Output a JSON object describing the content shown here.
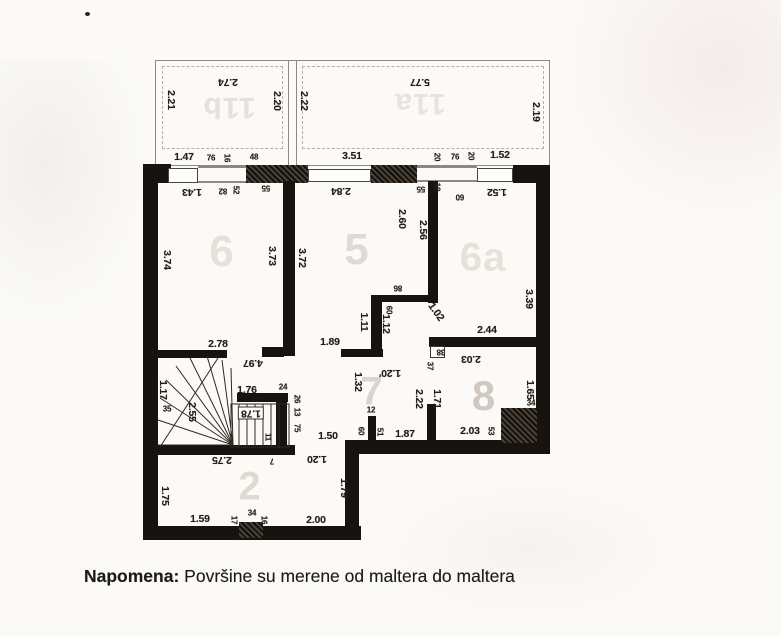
{
  "note": {
    "label": "Napomena:",
    "text": " Površine su merene od maltera do maltera"
  },
  "plan": {
    "room_labels": [
      {
        "t": "11b",
        "x": 229,
        "y": 107,
        "s": 30,
        "c": "#e6e1da",
        "r": 180
      },
      {
        "t": "11a",
        "x": 420,
        "y": 103,
        "s": 30,
        "c": "#e8e3dc",
        "r": 180
      },
      {
        "t": "6",
        "x": 222,
        "y": 252,
        "s": 44,
        "c": "#e5e0d9",
        "r": 0
      },
      {
        "t": "5",
        "x": 357,
        "y": 250,
        "s": 44,
        "c": "#dfdad3",
        "r": 0
      },
      {
        "t": "6a",
        "x": 483,
        "y": 258,
        "s": 40,
        "c": "#e7e1da",
        "r": 0
      },
      {
        "t": "7",
        "x": 372,
        "y": 392,
        "s": 40,
        "c": "#d9d4cd",
        "r": 0
      },
      {
        "t": "8",
        "x": 484,
        "y": 396,
        "s": 42,
        "c": "#cfc9c1",
        "r": 0
      },
      {
        "t": "2",
        "x": 250,
        "y": 487,
        "s": 40,
        "c": "#e0d9d1",
        "r": 0
      }
    ],
    "dimensions": [
      {
        "t": "2.74",
        "x": 228,
        "y": 82,
        "r": 180
      },
      {
        "t": "2.21",
        "x": 171,
        "y": 100,
        "r": 90
      },
      {
        "t": "2.20",
        "x": 277,
        "y": 101,
        "r": 90
      },
      {
        "t": "5.77",
        "x": 420,
        "y": 82,
        "r": 180
      },
      {
        "t": "2.22",
        "x": 304,
        "y": 101,
        "r": 90
      },
      {
        "t": "2.19",
        "x": 536,
        "y": 112,
        "r": 90
      },
      {
        "t": "1.47",
        "x": 184,
        "y": 157,
        "r": 0
      },
      {
        "t": "76",
        "x": 211,
        "y": 158,
        "r": 0,
        "s": 8
      },
      {
        "t": "16",
        "x": 227,
        "y": 158,
        "r": 90,
        "s": 8
      },
      {
        "t": "48",
        "x": 254,
        "y": 157,
        "r": 0,
        "s": 8
      },
      {
        "t": "3.51",
        "x": 352,
        "y": 156,
        "r": 0
      },
      {
        "t": "20",
        "x": 437,
        "y": 157,
        "r": 90,
        "s": 8
      },
      {
        "t": "76",
        "x": 455,
        "y": 157,
        "r": 0,
        "s": 8
      },
      {
        "t": "20",
        "x": 471,
        "y": 156,
        "r": 90,
        "s": 8
      },
      {
        "t": "1.52",
        "x": 500,
        "y": 155,
        "r": 0
      },
      {
        "t": "1.43",
        "x": 192,
        "y": 192,
        "r": 180
      },
      {
        "t": "82",
        "x": 223,
        "y": 191,
        "r": 180,
        "s": 8
      },
      {
        "t": "52",
        "x": 236,
        "y": 190,
        "r": 90,
        "s": 8
      },
      {
        "t": "55",
        "x": 266,
        "y": 188,
        "r": 180,
        "s": 8
      },
      {
        "t": "2.84",
        "x": 341,
        "y": 191,
        "r": 180
      },
      {
        "t": "55",
        "x": 421,
        "y": 189,
        "r": 180,
        "s": 8
      },
      {
        "t": "18",
        "x": 437,
        "y": 187,
        "r": 90,
        "s": 8
      },
      {
        "t": "60",
        "x": 460,
        "y": 197,
        "r": 180,
        "s": 8
      },
      {
        "t": "1.52",
        "x": 497,
        "y": 192,
        "r": 180
      },
      {
        "t": "3.74",
        "x": 167,
        "y": 260,
        "r": 90
      },
      {
        "t": "3.73",
        "x": 272,
        "y": 256,
        "r": 90
      },
      {
        "t": "2.78",
        "x": 218,
        "y": 344,
        "r": 0
      },
      {
        "t": "3.72",
        "x": 302,
        "y": 258,
        "r": 90
      },
      {
        "t": "2.60",
        "x": 402,
        "y": 219,
        "r": 90
      },
      {
        "t": "2.56",
        "x": 423,
        "y": 230,
        "r": 90
      },
      {
        "t": "86",
        "x": 398,
        "y": 288,
        "r": 180,
        "s": 8
      },
      {
        "t": "60",
        "x": 389,
        "y": 310,
        "r": 90,
        "s": 8
      },
      {
        "t": "1.11",
        "x": 364,
        "y": 322,
        "r": 90
      },
      {
        "t": "1.12",
        "x": 386,
        "y": 324,
        "r": 90
      },
      {
        "t": "1.89",
        "x": 330,
        "y": 342,
        "r": 0
      },
      {
        "t": "1.02",
        "x": 436,
        "y": 312,
        "r": 55
      },
      {
        "t": "3.39",
        "x": 529,
        "y": 299,
        "r": 90
      },
      {
        "t": "2.44",
        "x": 487,
        "y": 330,
        "r": 0
      },
      {
        "t": "2.03",
        "x": 471,
        "y": 359,
        "r": 180
      },
      {
        "t": "38",
        "x": 441,
        "y": 352,
        "r": 180,
        "s": 8
      },
      {
        "t": "37",
        "x": 430,
        "y": 366,
        "r": 90,
        "s": 8
      },
      {
        "t": "1.65",
        "x": 530,
        "y": 390,
        "r": 90
      },
      {
        "t": "2.22",
        "x": 419,
        "y": 399,
        "r": 90
      },
      {
        "t": "1.71",
        "x": 437,
        "y": 399,
        "r": 90
      },
      {
        "t": "2.03",
        "x": 470,
        "y": 431,
        "r": 0
      },
      {
        "t": "53",
        "x": 491,
        "y": 431,
        "r": 90,
        "s": 8
      },
      {
        "t": "34",
        "x": 531,
        "y": 403,
        "r": 0,
        "s": 8
      },
      {
        "t": "1.32",
        "x": 358,
        "y": 382,
        "r": 90
      },
      {
        "t": "1.20'",
        "x": 390,
        "y": 373,
        "r": 180
      },
      {
        "t": "12",
        "x": 371,
        "y": 410,
        "r": 0,
        "s": 8
      },
      {
        "t": "60",
        "x": 361,
        "y": 431,
        "r": 90,
        "s": 8
      },
      {
        "t": "51",
        "x": 380,
        "y": 432,
        "r": 90,
        "s": 8
      },
      {
        "t": "1.87",
        "x": 405,
        "y": 434,
        "r": 0
      },
      {
        "t": "1.50",
        "x": 328,
        "y": 436,
        "r": 0
      },
      {
        "t": "1.20",
        "x": 317,
        "y": 459,
        "r": 180
      },
      {
        "t": "7",
        "x": 272,
        "y": 461,
        "r": 180,
        "s": 8
      },
      {
        "t": "4.97",
        "x": 253,
        "y": 363,
        "r": 180
      },
      {
        "t": "1.17",
        "x": 163,
        "y": 390,
        "r": 90
      },
      {
        "t": "35",
        "x": 167,
        "y": 409,
        "r": 0,
        "s": 8
      },
      {
        "t": "2.55",
        "x": 192,
        "y": 412,
        "r": 90
      },
      {
        "t": "1.76",
        "x": 247,
        "y": 390,
        "r": 0
      },
      {
        "t": "24",
        "x": 283,
        "y": 387,
        "r": 0,
        "s": 8
      },
      {
        "t": "26",
        "x": 297,
        "y": 399,
        "r": 90,
        "s": 8
      },
      {
        "t": "13",
        "x": 297,
        "y": 412,
        "r": 90,
        "s": 8
      },
      {
        "t": "75",
        "x": 297,
        "y": 428,
        "r": 90,
        "s": 8
      },
      {
        "t": "1.78",
        "x": 251,
        "y": 413,
        "r": 180,
        "b": 1
      },
      {
        "t": "11",
        "x": 268,
        "y": 437,
        "r": 90,
        "s": 8
      },
      {
        "t": "2.75",
        "x": 222,
        "y": 460,
        "r": 180
      },
      {
        "t": "1.75",
        "x": 165,
        "y": 496,
        "r": 90
      },
      {
        "t": "1.79",
        "x": 344,
        "y": 488,
        "r": 90
      },
      {
        "t": "1.59",
        "x": 200,
        "y": 519,
        "r": 0
      },
      {
        "t": "17",
        "x": 234,
        "y": 520,
        "r": 90,
        "s": 8
      },
      {
        "t": "34",
        "x": 252,
        "y": 513,
        "r": 0,
        "s": 8
      },
      {
        "t": "16",
        "x": 264,
        "y": 520,
        "r": 90,
        "s": 8
      },
      {
        "t": "2.00",
        "x": 316,
        "y": 520,
        "r": 0
      }
    ]
  }
}
